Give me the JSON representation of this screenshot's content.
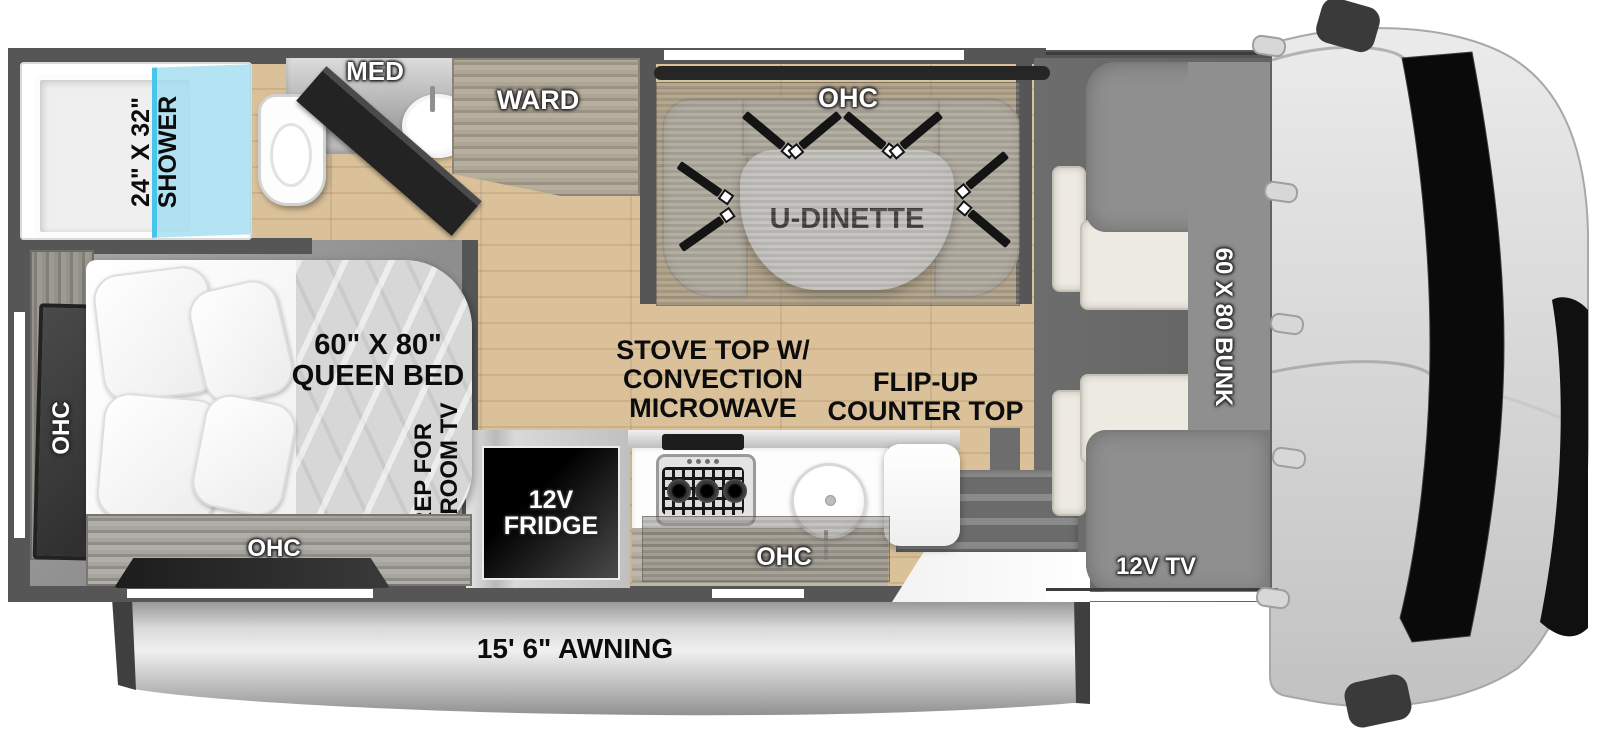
{
  "title": "Class C motorhome floor plan",
  "colors": {
    "wall": "#565656",
    "wood_floor": "#dac19a",
    "shower_glass": "#a3def2",
    "shower_glass_edge": "#45c6ea",
    "dinette_bench": "#d9d2c2",
    "bunk": "#8f8f8f",
    "cab_body": "#d9d9d9",
    "awning": "#c9c9c9",
    "label_black": "#0c0c0c",
    "label_white": "#ffffff"
  },
  "bathroom": {
    "shower_line1": "24\" X 32\"",
    "shower_line2": "SHOWER",
    "med": "MED"
  },
  "wardrobe": {
    "label": "WARD"
  },
  "dinette": {
    "ohc": "OHC",
    "table": "U-DINETTE"
  },
  "kitchen": {
    "stove_line1": "STOVE TOP W/",
    "stove_line2": "CONVECTION",
    "stove_line3": "MICROWAVE",
    "counter_line1": "FLIP-UP",
    "counter_line2": "COUNTER TOP",
    "fridge_line1": "12V",
    "fridge_line2": "FRIDGE",
    "ohc": "OHC"
  },
  "bedroom": {
    "bed_line1": "60\" X 80\"",
    "bed_line2": "QUEEN BED",
    "ohc_left": "OHC",
    "ohc_bottom": "OHC",
    "tv_prep_line1": "PREP FOR",
    "tv_prep_line2": "BEDROOM TV"
  },
  "cab": {
    "bunk": "60 X 80 BUNK",
    "tv": "12V TV"
  },
  "awning": {
    "label": "15' 6\" AWNING"
  }
}
